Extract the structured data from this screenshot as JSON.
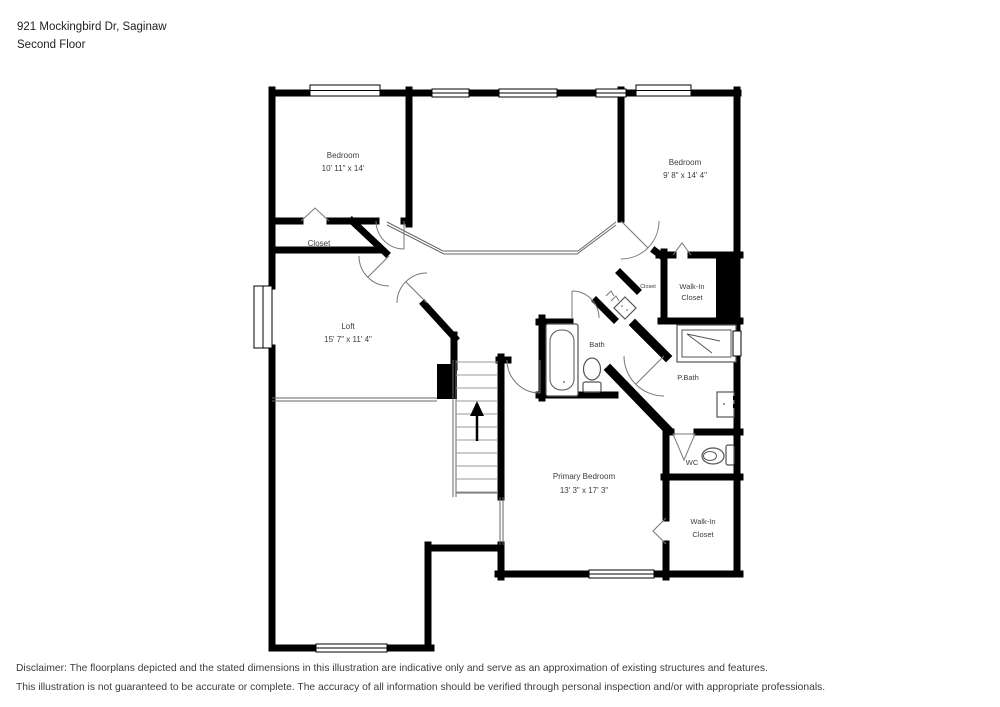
{
  "header": {
    "address": "921 Mockingbird Dr, Saginaw",
    "floor_label": "Second Floor"
  },
  "rooms": {
    "bedroom_left": {
      "name": "Bedroom",
      "dims": "10' 11\" x 14'"
    },
    "bedroom_right": {
      "name": "Bedroom",
      "dims": "9' 8\" x 14' 4\""
    },
    "closet": {
      "name": "Closet"
    },
    "loft": {
      "name": "Loft",
      "dims": "15' 7\" x 11' 4\""
    },
    "bath": {
      "name": "Bath"
    },
    "hall_closet": {
      "name": "Closet"
    },
    "walkin_closet_upper": {
      "line1": "Walk-In",
      "line2": "Closet"
    },
    "primary_bath": {
      "name": "P.Bath"
    },
    "wc": {
      "name": "WC"
    },
    "primary_bedroom": {
      "name": "Primary Bedroom",
      "dims": "13' 3\" x 17' 3\""
    },
    "walkin_closet_lower": {
      "line1": "Walk-In",
      "line2": "Closet"
    }
  },
  "disclaimer": {
    "line1": "Disclaimer: The floorplans depicted and the stated dimensions in this illustration are indicative only and serve as an approximation of existing structures and features.",
    "line2": "This illustration is not guaranteed to be accurate or complete. The accuracy of all information should be verified through personal inspection and/or with appropriate professionals."
  },
  "colors": {
    "wall": "#000000",
    "line": "#666666",
    "text": "#3d3d3d",
    "background": "#ffffff"
  }
}
